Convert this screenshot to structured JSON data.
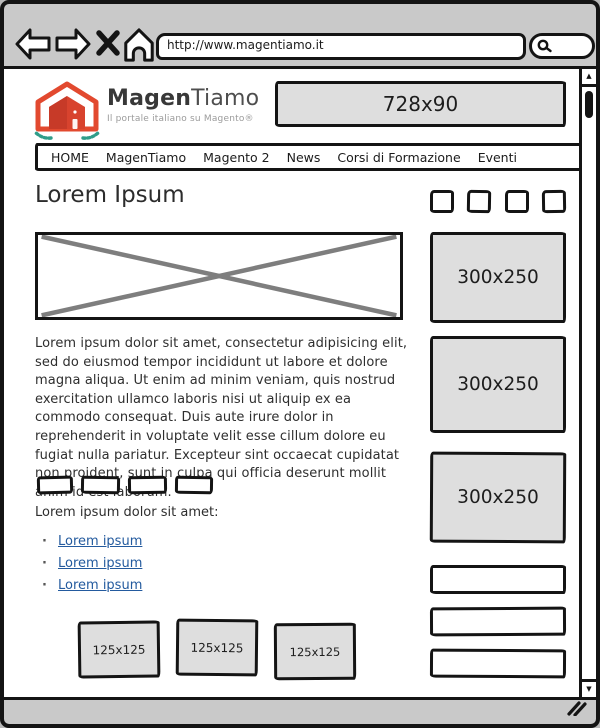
{
  "browser": {
    "url": "http://www.magentiamo.it",
    "scroll_up_glyph": "▲",
    "scroll_down_glyph": "▼"
  },
  "header": {
    "brand_bold": "Magen",
    "brand_light": "Tiamo",
    "tagline": "Il portale italiano su Magento®",
    "banner_label": "728x90"
  },
  "nav": {
    "items": [
      "HOME",
      "MagenTiamo",
      "Magento 2",
      "News",
      "Corsi di Formazione",
      "Eventi"
    ]
  },
  "main": {
    "heading": "Lorem Ipsum",
    "paragraph": "Lorem ipsum dolor sit amet, consectetur adipisicing elit, sed do eiusmod tempor incididunt ut labore et dolore magna aliqua. Ut enim ad minim veniam, quis nostrud exercitation ullamco laboris nisi ut aliquip ex ea commodo consequat. Duis aute irure dolor in reprehenderit in voluptate velit esse cillum dolore eu fugiat nulla pariatur. Excepteur sint occaecat cupidatat non proident, sunt in culpa qui officia deserunt mollit anim id est laborum.",
    "list_intro": "Lorem ipsum dolor sit amet:",
    "links": [
      "Lorem ipsum",
      "Lorem ipsum",
      "Lorem ipsum"
    ],
    "ads_small": [
      "125x125",
      "125x125",
      "125x125"
    ]
  },
  "sidebar": {
    "ads_medium": [
      "300x250",
      "300x250",
      "300x250"
    ]
  },
  "colors": {
    "logo_orange": "#E2492F",
    "logo_dark_orange": "#D8432E",
    "logo_teal": "#2F9D8A",
    "link_blue": "#235A9E",
    "chrome_gray": "#C9C9C9",
    "ad_gray": "#DEDEDE",
    "border_black": "#141414"
  }
}
